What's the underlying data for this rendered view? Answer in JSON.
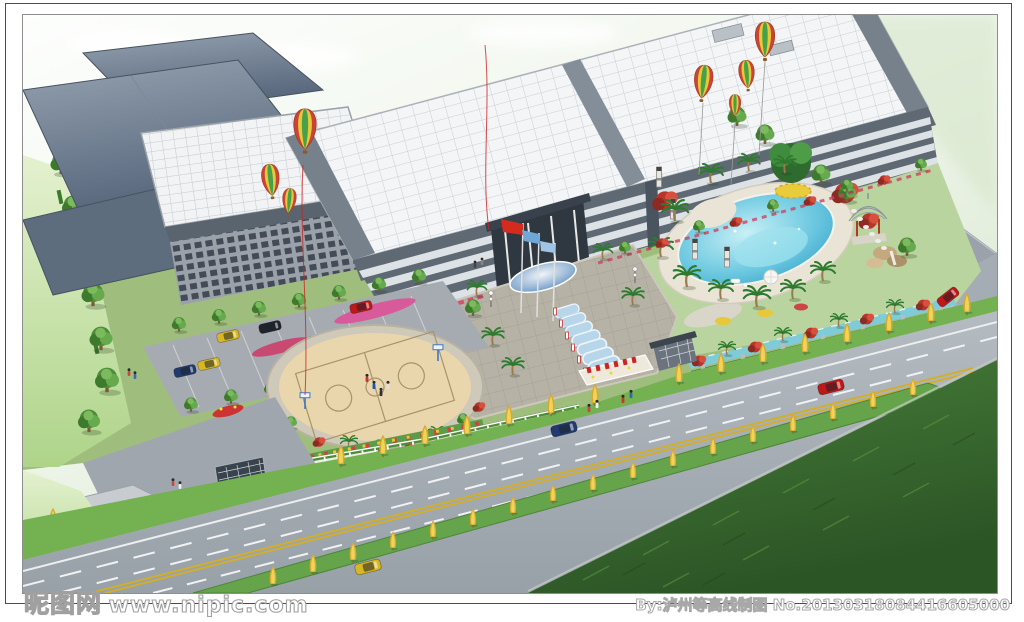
{
  "watermarks": {
    "site_name": "昵图网",
    "site_url": "www.nipic.com",
    "credit": "By:泸州等高线制图 No.20130318084416605000"
  },
  "frame": {
    "outer_border": "#4c4c4c",
    "inner_border": "#8e8e8e",
    "background": "#ffffff"
  },
  "scene": {
    "type": "aerial-architectural-rendering",
    "elements": [
      "factory buildings",
      "main office building",
      "glass skylight roofs",
      "hot air balloons",
      "red flag",
      "blue flags",
      "entrance plaza",
      "covered glass walkway",
      "parking lot with cars",
      "circular basketball court",
      "swimming pool",
      "poolside umbrella",
      "garden pavilion",
      "rock waterfall",
      "stream",
      "gate house",
      "boom barrier",
      "sign wall",
      "flower beds",
      "white picket fence",
      "hedge wall",
      "palm trees",
      "golden roadside trees",
      "multi-lane road",
      "double yellow line",
      "green median strip",
      "cars on road",
      "pedestrians",
      "grass field"
    ],
    "palette": {
      "sky": "#eef5ea",
      "slate_roof": "#5d6d7e",
      "skylight_roof": "#f3f5f6",
      "facade": "#5f6974",
      "lawn": "#74b150",
      "pool_water": "#35a8cc",
      "road": "#a8b0b6",
      "median_tree": "#e0b62f",
      "grass_field": "#3c6e30",
      "flag_red": "#d42b1e",
      "flag_blue": "#6fa8d8",
      "balloon_red": "#c94436",
      "balloon_yellow": "#e8c838",
      "balloon_green": "#47a14b"
    }
  }
}
